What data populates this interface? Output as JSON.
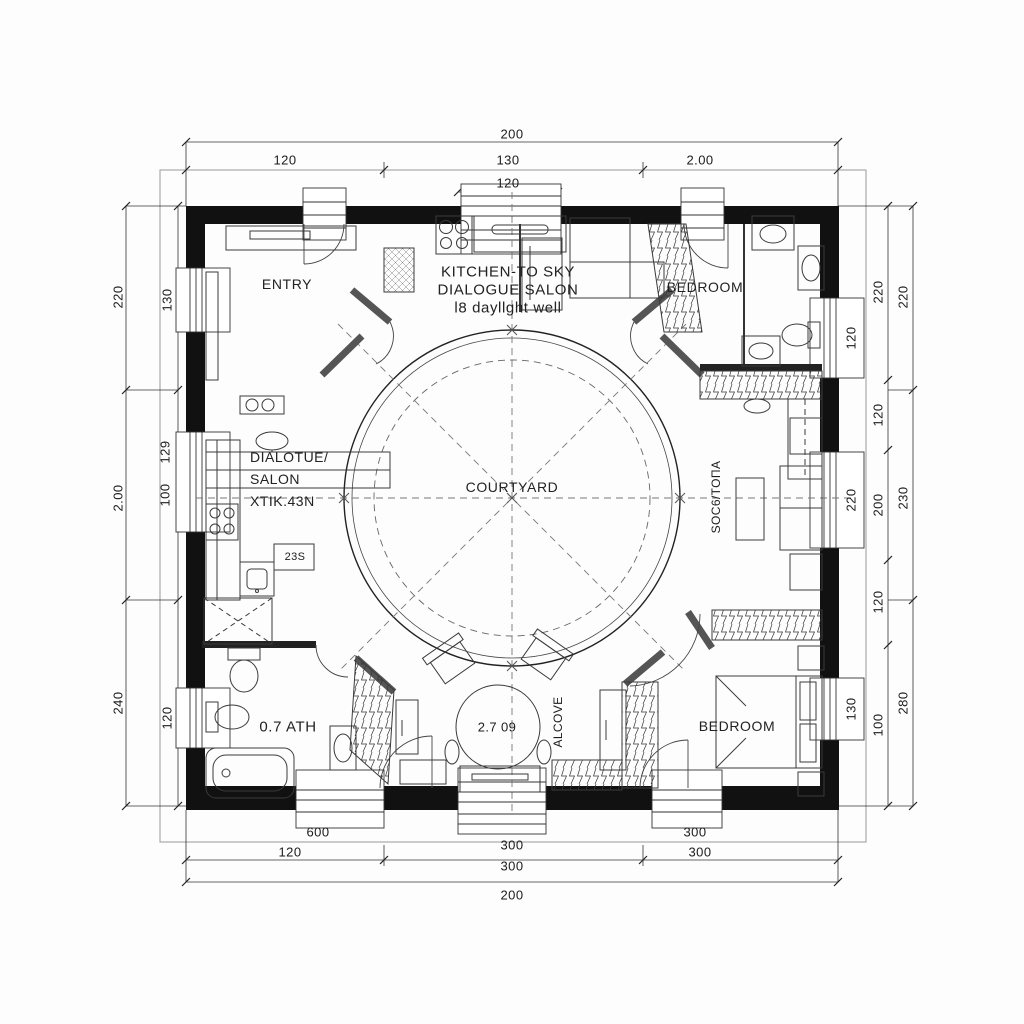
{
  "rooms": {
    "entry": "ENTRY",
    "kitchen_l1": "KITCHEN-TO SKY",
    "kitchen_l2": "DIALOGUE SALON",
    "kitchen_l3": "l8 dayllght well",
    "bedroom_tr": "BEDROOM",
    "salon_l1": "DIALOTUE/",
    "salon_l2": "SALON",
    "salon_l3": "XTIK.43N",
    "courtyard": "COURTYARD",
    "sofa": "SOC6/TOΠA",
    "bath": "0.7 ATH",
    "table": "2.7 09",
    "alcove": "ALCOVE",
    "bedroom_br": "BEDROOM",
    "cabinet": "23S"
  },
  "dims": {
    "top": {
      "overall": "200",
      "seg1": "120",
      "seg2": "130",
      "seg3": "2.00",
      "sub": "120"
    },
    "bottom": {
      "win1": "600",
      "win2": "300",
      "win3": "300",
      "seg1": "120",
      "seg2": "300",
      "seg3": "300",
      "overall": "200"
    },
    "left": {
      "out1": "220",
      "out2": "2.00",
      "out3": "240",
      "win1": "130",
      "win2a": "129",
      "win2b": "100",
      "win3": "120"
    },
    "right": {
      "in1": "220",
      "in2": "120",
      "in3": "200",
      "in4": "120",
      "in5": "100",
      "win1": "120",
      "win2": "220",
      "win3": "130",
      "out1": "220",
      "out2": "230",
      "out3": "280"
    }
  }
}
